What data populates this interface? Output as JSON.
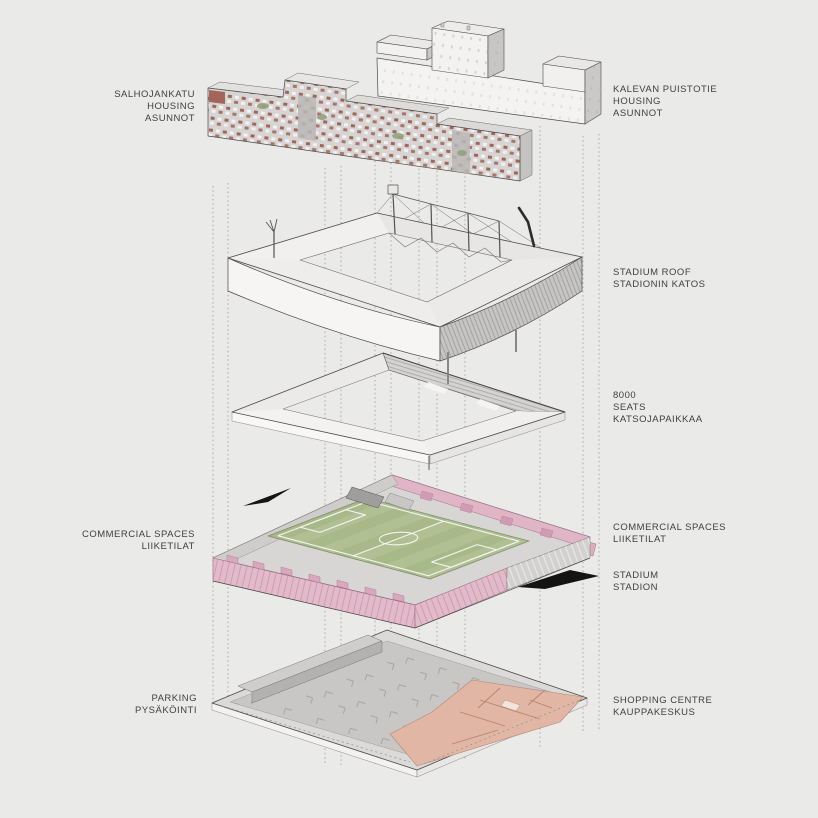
{
  "labels": {
    "salhojankatu": "SALHOJANKATU\nHOUSING\nASUNNOT",
    "kalevan": "KALEVAN PUISTOTIE\nHOUSING\nASUNNOT",
    "stadium_roof": "STADIUM ROOF\nSTADIONIN KATOS",
    "seats": "8000\nSEATS\nKATSOJAPAIKKAA",
    "commercial_left": "COMMERCIAL SPACES\nLIIKETILAT",
    "commercial_right": "COMMERCIAL SPACES\nLIIKETILAT",
    "stadium": "STADIUM\nSTADION",
    "parking": "PARKING\nPYSÄKÖINTI",
    "shopping": "SHOPPING CENTRE\nKAUPPAKESKUS"
  },
  "layer_order_top_to_bottom": [
    "housing",
    "stadium-roof",
    "seating-8000",
    "stadium-with-commercial-spaces",
    "parking-and-shopping-centre"
  ],
  "colors": {
    "background": "#eaeae8",
    "ink": "#3f3f3d",
    "outline": "#4a4a48",
    "pitch_green": "#a7b889",
    "pitch_stripe": "#b0c092",
    "commercial_pink": "#e3bac9",
    "shopping_salmon": "#e1b6a4",
    "facade_red": "#a3655a",
    "arrow_black": "#141414"
  }
}
